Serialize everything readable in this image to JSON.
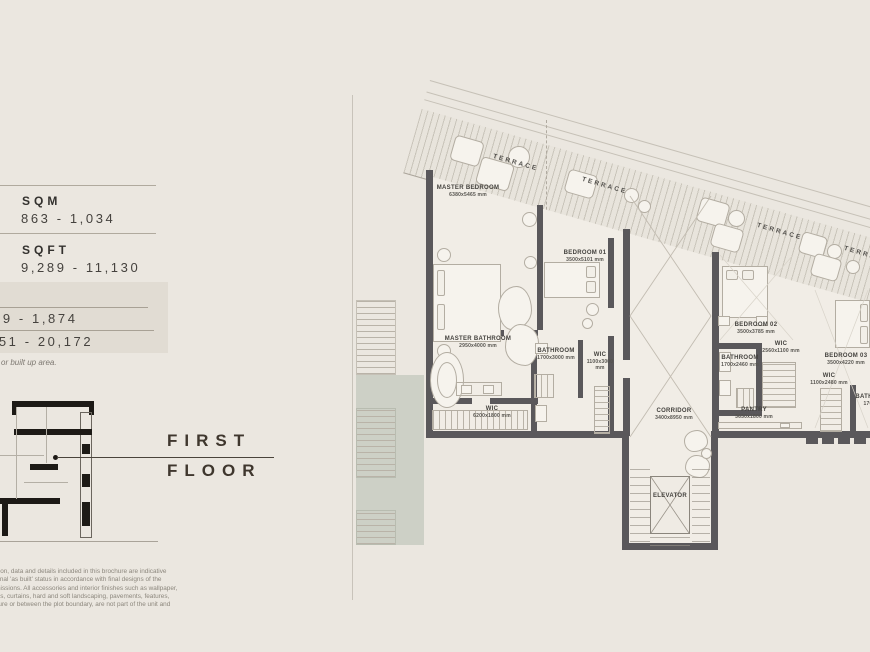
{
  "colors": {
    "background": "#ebe7e0",
    "wall": "#5a585b",
    "room_fill": "#f1ede6",
    "shade_box": "#e1dcd3",
    "planter_green": "#cdd0c6",
    "text_dark": "#3c3a37"
  },
  "sidebar": {
    "sqm": {
      "label": "SQM",
      "value": "863 - 1,034"
    },
    "sqft": {
      "label": "SQFT",
      "value": "9,289 - 11,130"
    },
    "plot_box": {
      "line1": "49 - 1,874",
      "line2": "951 - 20,172"
    },
    "note": "or built up area.",
    "floor": {
      "line1": "FIRST",
      "line2": "FLOOR"
    },
    "disclaimer": [
      "rmation, data and details included in this brochure are indicative",
      "the final 'as built' status in accordance with final designs of the",
      "permissions. All accessories and interior finishes such as wallpaper,",
      "goods, curtains, hard and soft landscaping, pavements, features,",
      "rochure or between the plot boundary, are not part of the unit and"
    ]
  },
  "plan": {
    "terrace_labels": [
      {
        "text": "TERRACE",
        "x": 494,
        "y": 153
      },
      {
        "text": "TERRACE",
        "x": 583,
        "y": 176
      },
      {
        "text": "TERRACE",
        "x": 758,
        "y": 222
      },
      {
        "text": "TERRACE",
        "x": 845,
        "y": 245
      }
    ],
    "rooms": [
      {
        "label": "MASTER BEDROOM",
        "dims": "6380x5465 mm",
        "x": 468,
        "y": 185
      },
      {
        "label": "BEDROOM 01",
        "dims": "3500x5101 mm",
        "x": 585,
        "y": 250
      },
      {
        "label": "MASTER BATHROOM",
        "dims": "2950x4000 mm",
        "x": 478,
        "y": 336
      },
      {
        "label": "BATHROOM",
        "dims": "1700x3000 mm",
        "x": 556,
        "y": 348
      },
      {
        "label": "WIC",
        "dims": "1100x3000 mm",
        "x": 600,
        "y": 352,
        "w": 36
      },
      {
        "label": "WIC",
        "dims": "6200x1800 mm",
        "x": 492,
        "y": 406
      },
      {
        "label": "BEDROOM 02",
        "dims": "3500x3785 mm",
        "x": 756,
        "y": 322
      },
      {
        "label": "WIC",
        "dims": "2560x1100 mm",
        "x": 781,
        "y": 341
      },
      {
        "label": "BATHROOM",
        "dims": "1700x2460 mm",
        "x": 740,
        "y": 355
      },
      {
        "label": "BEDROOM 03",
        "dims": "3500x4220 mm",
        "x": 846,
        "y": 353
      },
      {
        "label": "WIC",
        "dims": "1100x2480 mm",
        "x": 829,
        "y": 373
      },
      {
        "label": "BATHROOM",
        "dims": "1700x29",
        "x": 874,
        "y": 394
      },
      {
        "label": "CORRIDOR",
        "dims": "3400x8950 mm",
        "x": 674,
        "y": 408
      },
      {
        "label": "PANTRY",
        "dims": "3650x1800 mm",
        "x": 754,
        "y": 407
      },
      {
        "label": "ELEVATOR",
        "dims": "",
        "x": 670,
        "y": 493
      }
    ]
  }
}
